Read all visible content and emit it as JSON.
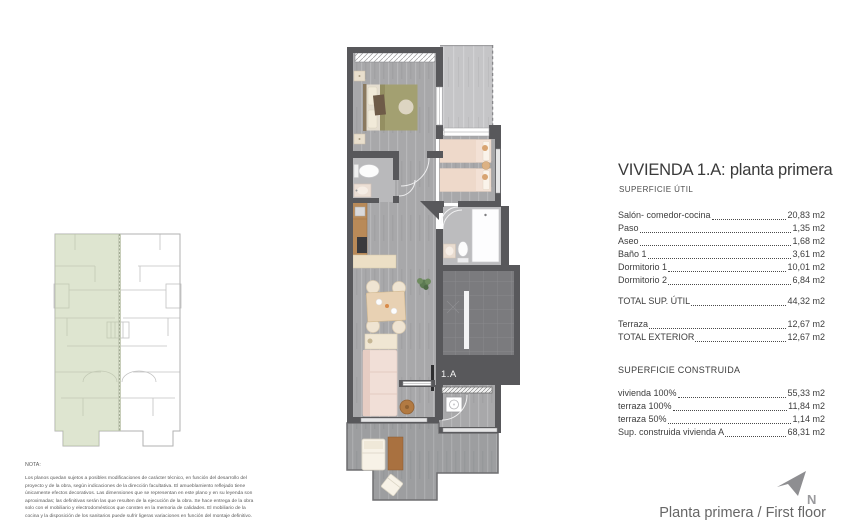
{
  "header": {
    "title": "VIVIENDA 1.A: planta primera"
  },
  "sections": {
    "util": {
      "heading": "SUPERFICIE ÚTIL",
      "rows": [
        {
          "label": "Salón- comedor-cocina",
          "value": "20,83 m2"
        },
        {
          "label": "Paso",
          "value": "1,35 m2"
        },
        {
          "label": "Aseo",
          "value": "1,68 m2"
        },
        {
          "label": "Baño 1",
          "value": "3,61 m2"
        },
        {
          "label": "Dormitorio 1",
          "value": "10,01 m2"
        },
        {
          "label": "Dormitorio 2",
          "value": "6,84 m2"
        }
      ],
      "total": {
        "label": "TOTAL SUP. ÚTIL",
        "value": "44,32 m2"
      }
    },
    "exterior": {
      "rows": [
        {
          "label": "Terraza",
          "value": "12,67 m2"
        },
        {
          "label": "TOTAL EXTERIOR",
          "value": "12,67 m2"
        }
      ]
    },
    "construida": {
      "heading": "SUPERFICIE CONSTRUIDA",
      "rows": [
        {
          "label": "vivienda 100%",
          "value": "55,33 m2"
        },
        {
          "label": "terraza 100%",
          "value": "11,84 m2"
        },
        {
          "label": "terraza 50%",
          "value": "1,14 m2"
        },
        {
          "label": "Sup. construida vivienda A",
          "value": "68,31 m2"
        }
      ]
    }
  },
  "note": {
    "heading": "NOTA:",
    "body": "Los planos quedan sujetos a posibles modificaciones de carácter técnico, en función del desarrollo del proyecto y de la obra, según indicaciones de la dirección facultativa. El amueblamiento reflejado tiene únicamente efectos decorativos. Las dimensiones que se representan en este plano y en su leyenda son aproximadas; las definitivas serán las que resulten de la ejecución de la obra. Se hace entrega de la obra solo con el mobiliario y electrodomésticos que consten en la memoria de calidades. El mobiliario de la cocina y la disposición de los sanitarios puede sufrir ligeras variaciones en función del montaje definitivo."
  },
  "plan": {
    "unit_label": "1.A"
  },
  "footer": {
    "caption": "Planta primera / First floor",
    "north_label": "N"
  },
  "colors": {
    "wall_gray": "#58585b",
    "floor_gray": "#a8a8aa",
    "terrace_light": "#c5c5c7",
    "deck_gray": "#9d9ea0",
    "highlight_green": "#c3d0a9",
    "text_dark": "#3a3a3a",
    "muted_gray": "#8b8b8e"
  }
}
